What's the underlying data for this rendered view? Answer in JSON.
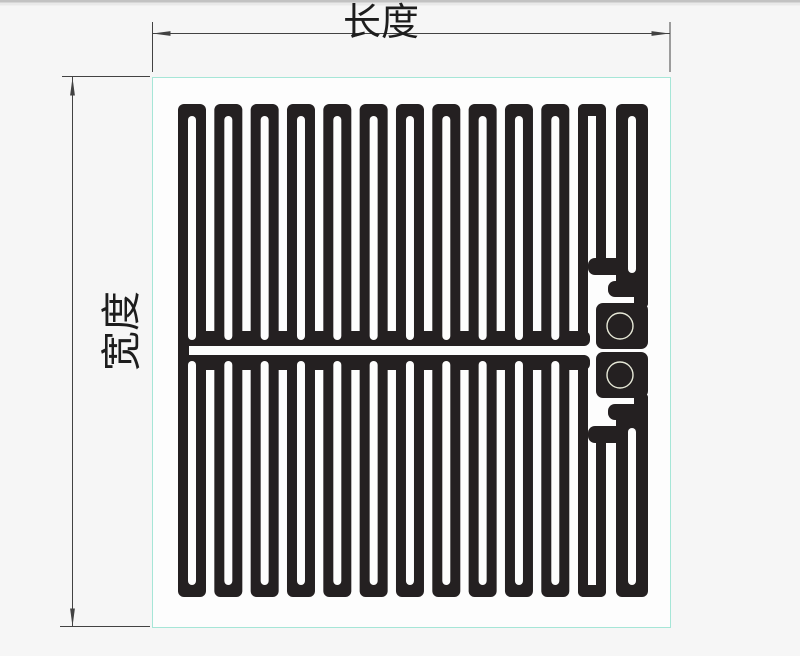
{
  "page": {
    "background": "#f6f6f6",
    "top_edge_color": "#c2c2c2",
    "top_edge_fade": "#e9e9e9"
  },
  "diagram": {
    "type": "flexible-heating-film-technical-drawing",
    "labels": {
      "length": "长度",
      "width": "宽度"
    },
    "colors": {
      "trace": "#242021",
      "panel_fill": "#fdfdfd",
      "panel_border": "#a6e6d7",
      "dimension": "#424242",
      "label_text": "#1d1d1d",
      "pad_ring": "#e7e9d8"
    },
    "panel": {
      "x": 152,
      "y": 77,
      "width": 518,
      "height": 550
    },
    "length_dimension": {
      "line_y": 33.5,
      "x1": 152.5,
      "x2": 669.5,
      "ext_y1": 22,
      "ext_y2": 72,
      "label_x": 381,
      "label_y": 35,
      "font_size": 38
    },
    "width_dimension": {
      "line_x": 72.5,
      "y1": 77,
      "y2": 627,
      "top_ext": [
        62,
        150,
        76.5
      ],
      "bottom_ext": [
        60,
        150,
        626.5
      ],
      "label_x": 121,
      "label_y": 345,
      "label_cx": 121,
      "label_cy": 331,
      "font_size": 40
    },
    "arrow": {
      "length": 18,
      "half_width": 2.4
    },
    "meander": {
      "normal_columns": 11,
      "first_x": 178,
      "pitch": 36.33,
      "col_width": 28,
      "block_y": 104,
      "block_h": 242,
      "corner_radius": 6,
      "slot_offset": 10,
      "slot_width": 8,
      "slot_y": 116,
      "slot_h": 224,
      "slot_radius": 4,
      "band": [
        178,
        331,
        412,
        15,
        6
      ],
      "connector": [
        178,
        340,
        11,
        21,
        0
      ],
      "mirror_sum": 701
    },
    "terminal": {
      "black_shapes": [
        [
          578,
          104,
          10,
          242,
          5
        ],
        [
          578,
          104,
          28,
          12,
          6
        ],
        [
          596,
          104,
          10,
          171,
          5
        ],
        [
          588,
          258,
          40,
          17,
          7
        ],
        [
          616,
          104,
          32,
          193,
          6
        ],
        [
          608,
          281,
          40,
          16,
          7
        ],
        [
          634,
          281,
          14,
          26,
          3
        ],
        [
          596,
          303,
          52,
          46,
          7
        ]
      ],
      "white_shapes": [
        [
          628,
          116,
          8,
          157,
          4
        ]
      ],
      "pad_hole": {
        "cx": 620,
        "cy": 326,
        "r": 13,
        "stroke_width": 1.4
      }
    }
  }
}
